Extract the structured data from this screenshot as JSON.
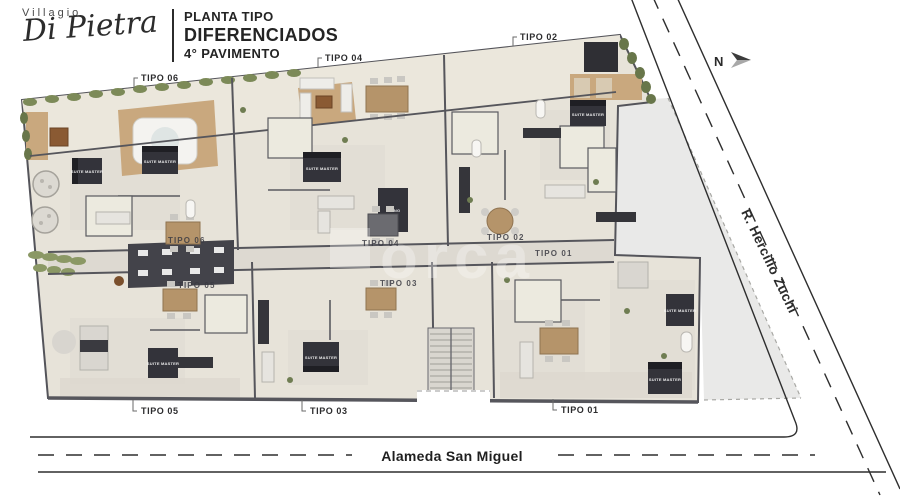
{
  "header": {
    "brand_top": "Villagio",
    "brand_script": "Di Pietra",
    "title_lines": [
      "PLANTA TIPO",
      "DIFERENCIADOS",
      "4° PAVIMENTO"
    ]
  },
  "compass": {
    "north_label": "N"
  },
  "streets": {
    "right_street": "R. Hercilio Zuchi",
    "bottom_street": "Alameda San Miguel"
  },
  "callouts": {
    "top": [
      {
        "label": "TIPO",
        "number": "06"
      },
      {
        "label": "TIPO",
        "number": "04"
      },
      {
        "label": "TIPO",
        "number": "02"
      }
    ],
    "bottom": [
      {
        "label": "TIPO",
        "number": "05"
      },
      {
        "label": "TIPO",
        "number": "03"
      },
      {
        "label": "TIPO",
        "number": "01"
      }
    ]
  },
  "plan_unit_labels": [
    "TIPO 06",
    "TIPO 04",
    "TIPO 02",
    "TIPO 05",
    "TIPO 03",
    "TIPO 01"
  ],
  "room_labels": {
    "suite": "SUITE MASTER",
    "living": "LIVING"
  },
  "watermark": "orca",
  "colors": {
    "floor": "#e7e3d9",
    "terrace_floor": "#ebe7dc",
    "deck": "#c9a87e",
    "wall": "#55555c",
    "plaza": "#e9e9e8",
    "hedge": "#7c8a58",
    "street_line": "#2e2e2e"
  }
}
